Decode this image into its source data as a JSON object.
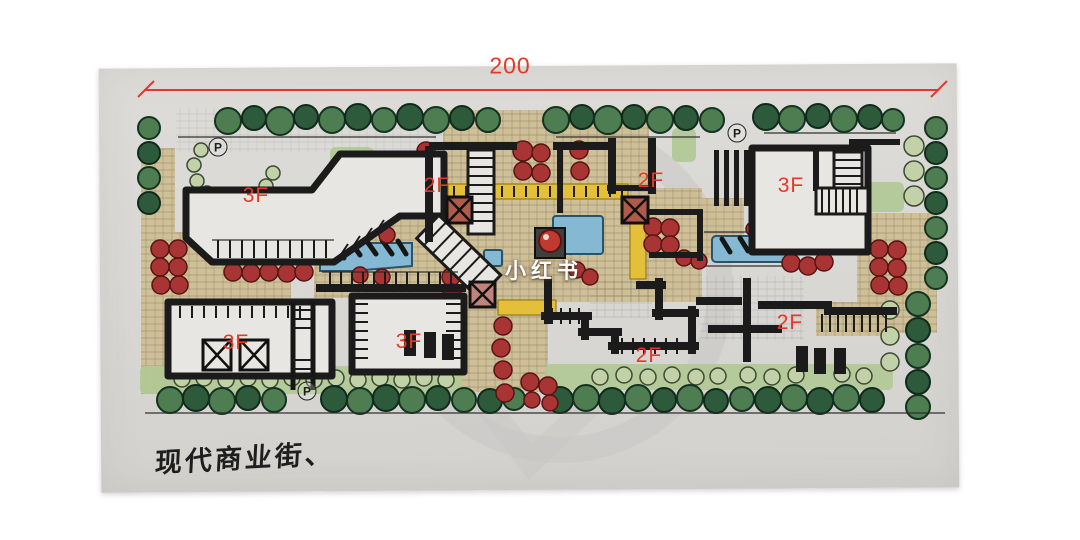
{
  "dimension": {
    "label": "200"
  },
  "watermark": {
    "text": "小红书"
  },
  "caption": {
    "text": "现代商业街、"
  },
  "floor_labels": [
    {
      "text": "3F",
      "x": 256,
      "y": 196
    },
    {
      "text": "2F",
      "x": 437,
      "y": 186
    },
    {
      "text": "2F",
      "x": 651,
      "y": 181
    },
    {
      "text": "3F",
      "x": 791,
      "y": 186
    },
    {
      "text": "3F",
      "x": 236,
      "y": 343
    },
    {
      "text": "3F",
      "x": 409,
      "y": 342
    },
    {
      "text": "2F",
      "x": 649,
      "y": 356
    },
    {
      "text": "2F",
      "x": 790,
      "y": 323
    }
  ],
  "parking_labels": [
    {
      "text": "P",
      "x": 218,
      "y": 147
    },
    {
      "text": "P",
      "x": 737,
      "y": 133
    },
    {
      "text": "P",
      "x": 307,
      "y": 391
    }
  ],
  "palette": {
    "paper": "#d9d8d5",
    "ink": "#1b1b1b",
    "tree": "#4e7d52",
    "lawn": "#b2c995",
    "bush": "#a93434",
    "water": "#85b8d2",
    "canopy": "#e3bf3a",
    "paving": "#cdbc8e",
    "label_red": "#e23a28",
    "watermark_gray": "#c7c6c3"
  }
}
